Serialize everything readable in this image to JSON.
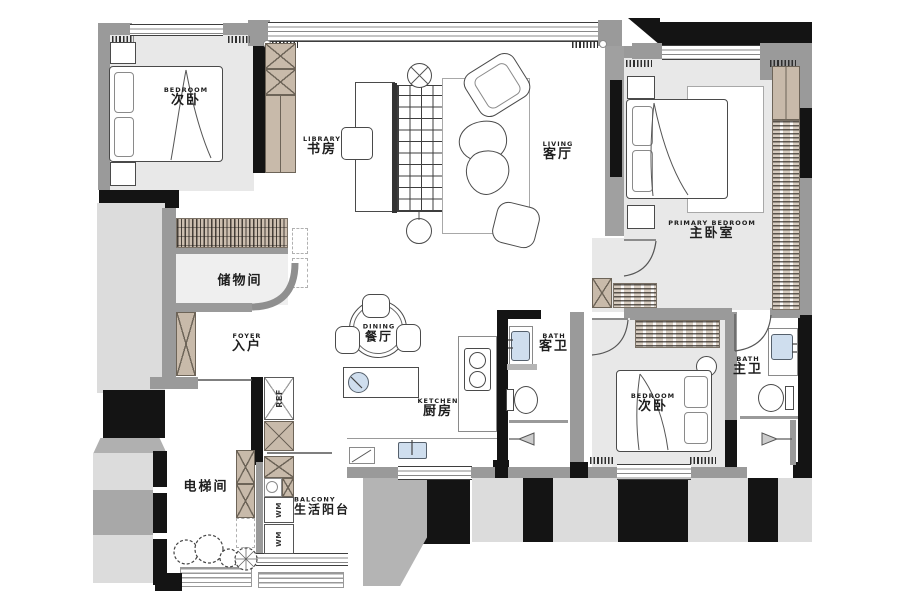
{
  "plan": {
    "title": "apartment-floor-plan",
    "rooms": {
      "bedroom_tl": {
        "en": "BEDROOM",
        "zh": "次卧"
      },
      "library": {
        "en": "LIBRARY",
        "zh": "书房"
      },
      "living": {
        "en": "LIVING",
        "zh": "客厅"
      },
      "primary_bedroom": {
        "en": "PRIMARY BEDROOM",
        "zh": "主卧室"
      },
      "storage": {
        "en": "",
        "zh": "储物间"
      },
      "foyer": {
        "en": "FOYER",
        "zh": "入户"
      },
      "dining": {
        "en": "DINING",
        "zh": "餐厅"
      },
      "kitchen": {
        "en": "KETCHEN",
        "zh": "厨房"
      },
      "guest_bath": {
        "en": "BATH",
        "zh": "客卫"
      },
      "master_bath": {
        "en": "BATH",
        "zh": "主卫"
      },
      "bedroom_br": {
        "en": "BEDROOM",
        "zh": "次卧"
      },
      "elevator": {
        "en": "",
        "zh": "电梯间"
      },
      "balcony": {
        "en": "BALCONY",
        "zh": "生活阳台"
      }
    },
    "appliances": {
      "fridge": "REF",
      "washer_top": "WM",
      "washer_bottom": "WM"
    },
    "colors": {
      "wall_black": "#141414",
      "wall_gray": "#9a9a9a",
      "floor_gray": "#e8e8e8",
      "wood_tan": "#c8baaa",
      "fixture_blue": "#cfdeee",
      "exterior_light": "#dcdcdc",
      "exterior_mid": "#a8a8a8"
    }
  }
}
